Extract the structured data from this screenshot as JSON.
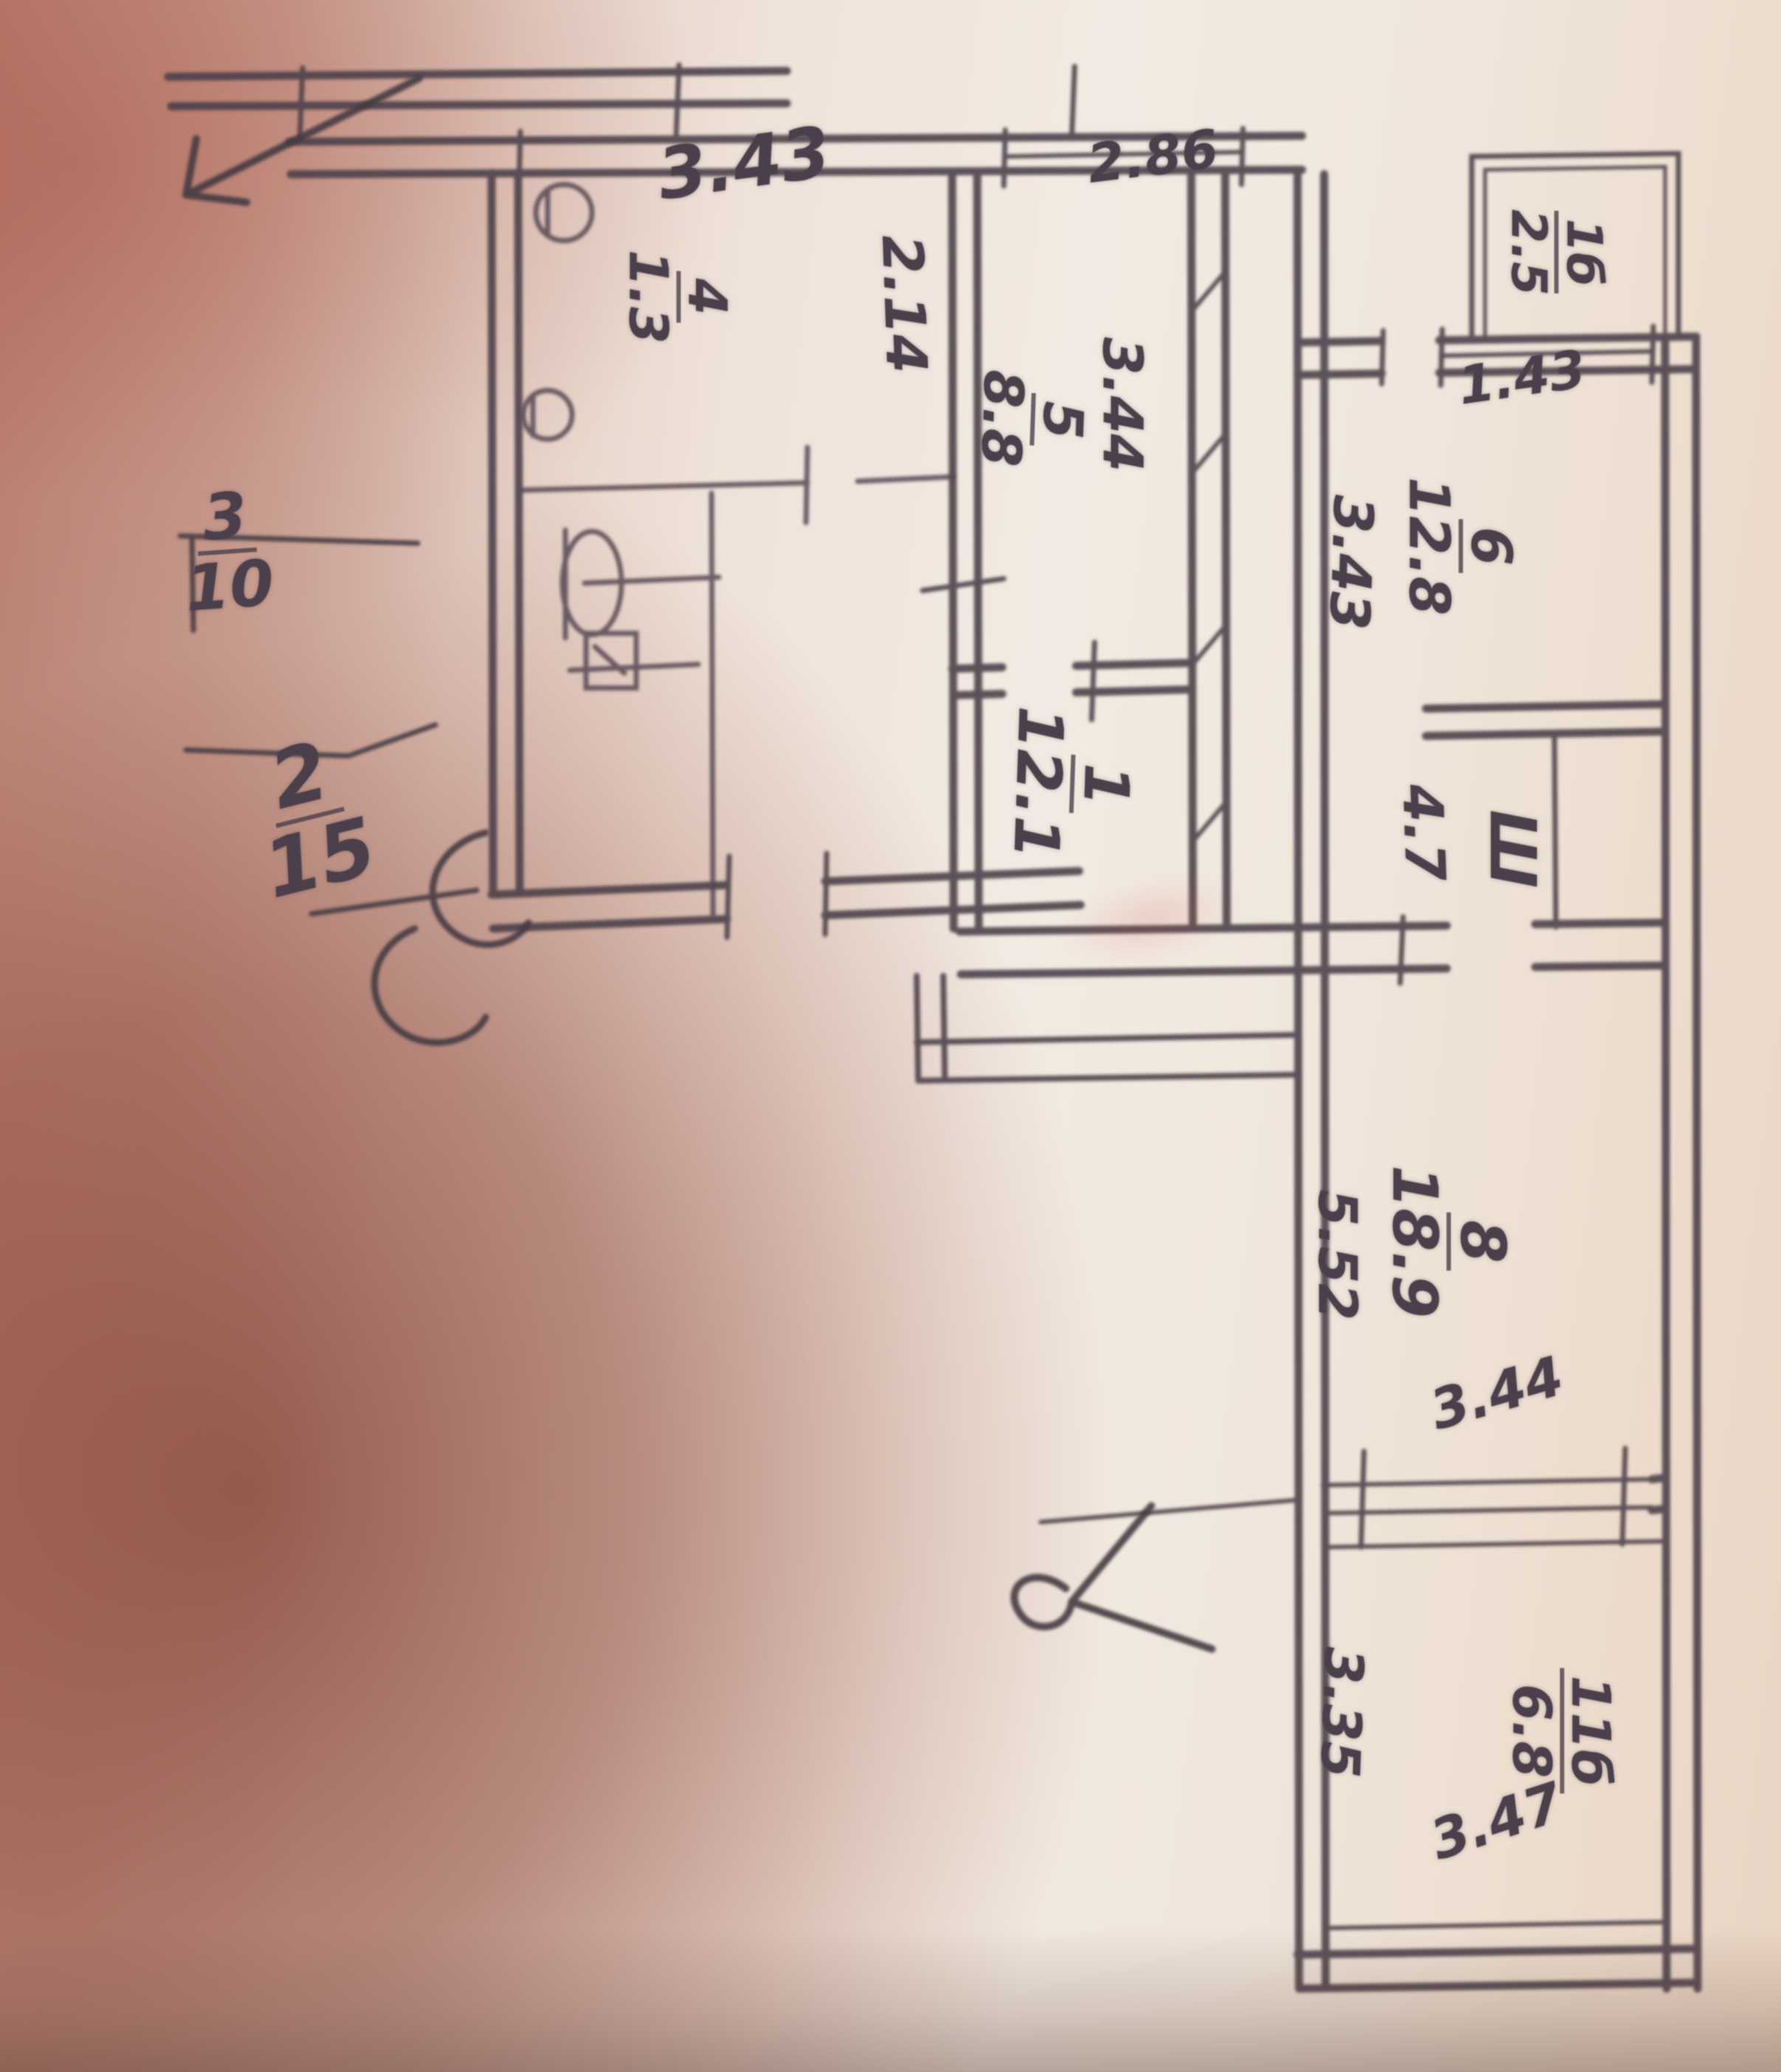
{
  "document": {
    "kind": "hand-drawn apartment floor plan (BTI sketch), photographed on paper",
    "orientation_note": "room labels are written rotated 90 degrees (read with head tilted right)"
  },
  "colors": {
    "ink": "#4a3e46",
    "paper_light": "#f1e8e0",
    "shadow_brown": "#8f5346",
    "red_smudge": "#cd4637"
  },
  "rooms": {
    "r1": {
      "number": "1",
      "area": "12.1"
    },
    "r4": {
      "number": "4",
      "area": "1.3"
    },
    "r5": {
      "number": "5",
      "area": "8.8"
    },
    "r6": {
      "number": "6",
      "area": "12.8"
    },
    "r8": {
      "number": "8",
      "area": "18.9"
    },
    "balcony": {
      "number": "1б",
      "area": "2.5"
    },
    "loggia": {
      "number": "11б",
      "area": "6.8"
    }
  },
  "dimensions": {
    "top_left_wall": "3.43",
    "bath_width": "2.14",
    "kitchen_depth": "3.44",
    "kitchen_window": "2.86",
    "balcony_window": "1.43",
    "room6_depth": "3.43",
    "hall_width": "4.7",
    "room8_depth": "5.52",
    "room8_window": "3.44",
    "loggia_left": "3.35",
    "loggia_window": "3.47"
  },
  "annotations": {
    "stair_upper": {
      "num": "3",
      "den": "10"
    },
    "stair_lower": {
      "num": "2",
      "den": "15"
    },
    "closet_symbol": "Ш"
  }
}
